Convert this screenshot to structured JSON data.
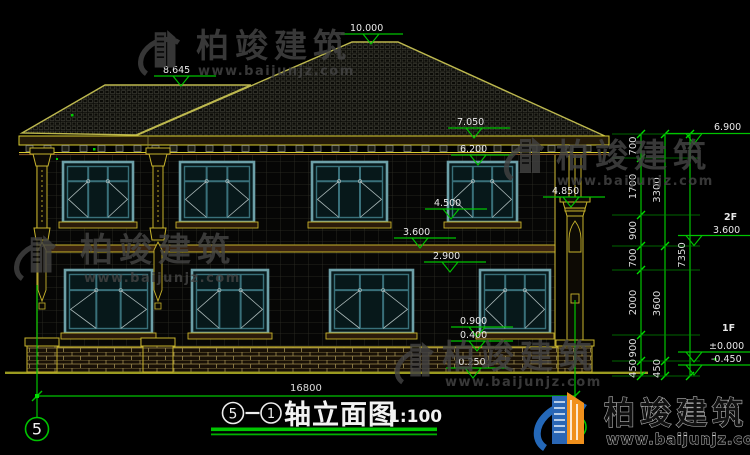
{
  "watermark": {
    "brand": "柏竣建筑",
    "url": "www.baijunjz.com"
  },
  "markers": {
    "ridge_main": "10.000",
    "ridge_left": "8.645",
    "eave_top": "7.050",
    "win2_top": "6.200",
    "col_cap": "4.850",
    "win2_sill": "4.500",
    "floor2": "3.600",
    "win1_top": "2.900",
    "win1_sill": "0.900",
    "base_top": "0.400",
    "ground": "-0.250"
  },
  "right": {
    "eave": "6.900",
    "floor2_label": "2F",
    "floor2_level": "3.600",
    "floor1_label": "1F",
    "floor1_level": "±0.000",
    "ground_level": "-0.450",
    "chain1": [
      "700",
      "1700",
      "900",
      "700",
      "2000",
      "900",
      "450"
    ],
    "chain2": [
      "3300",
      "3600",
      "450"
    ],
    "total": "7350"
  },
  "bottom": {
    "overall_width": "16800",
    "axis_left": "5",
    "axis_right": "1"
  },
  "title": {
    "axis_left": "5",
    "axis_right": "1",
    "name": "轴立面图",
    "scale": "1:100"
  }
}
